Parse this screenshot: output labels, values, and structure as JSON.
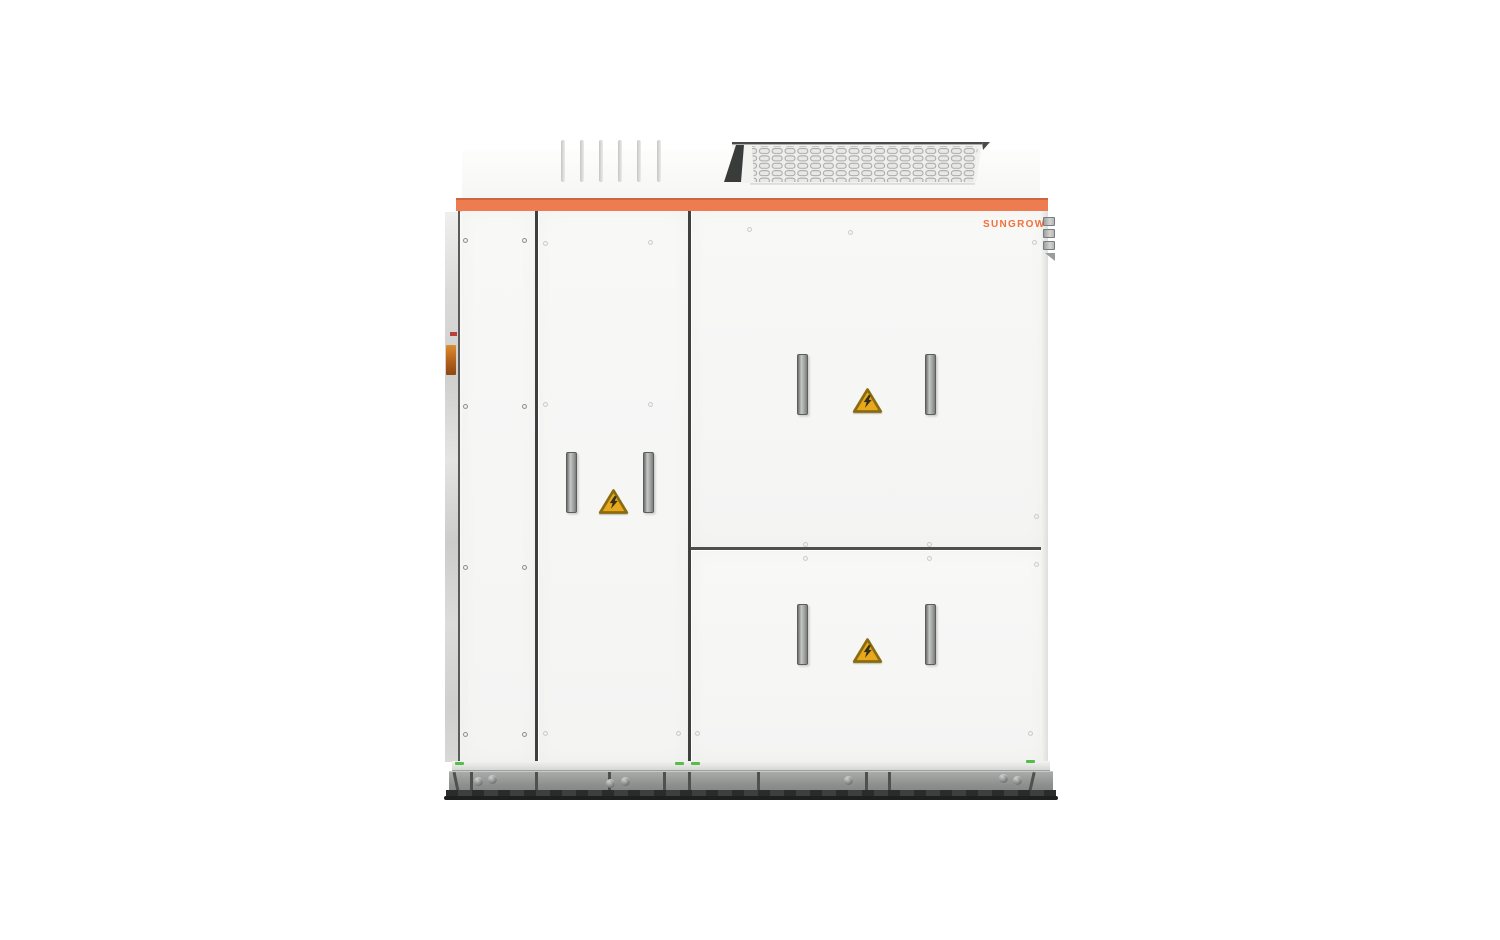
{
  "brand": {
    "label": "SUNGROW"
  },
  "colors": {
    "accent_orange": "#ED7C51",
    "brand_orange": "#F2703A",
    "warning_yellow": "#E9A81B",
    "warning_border": "#8a6c10",
    "indicator_green": "#55BE4A"
  },
  "equipment": {
    "panels": [
      "left-service-panel",
      "middle-door",
      "upper-right-door",
      "lower-right-door"
    ],
    "handle_count": 6,
    "warning_label_count": 3,
    "warning_icon": "high-voltage-warning-icon",
    "visible_features": [
      "roof-vent-slats",
      "ventilation-grille",
      "accent-stripe",
      "steel-base-skid",
      "hinge-bracket"
    ]
  }
}
